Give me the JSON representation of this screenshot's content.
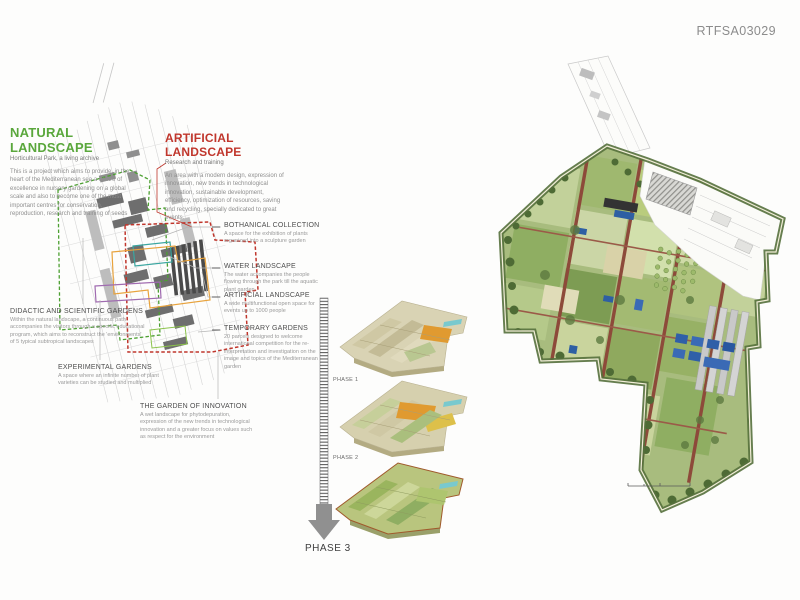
{
  "board": {
    "code": "RTFSA03029"
  },
  "natural_landscape": {
    "title": "NATURAL LANDSCAPE",
    "subtitle": "Horticultural Park, a living archive",
    "body": "This is a project which aims to provide, in the heart of the Mediterranean sea a centre of excellence in nursery gardening on a global scale and also to become one of the most important centres for conservation, reproduction, research and training of seeds"
  },
  "artificial_landscape": {
    "title": "ARTIFICIAL LANDSCAPE",
    "subtitle": "Research and training",
    "body": "An area with a modern design, expression of innovation, new trends in technological innovation, sustainable development, efficiency, optimization of resources, saving and recycling, specially dedicated to great events."
  },
  "callouts_right": [
    {
      "title": "BOTHANICAL COLLECTION",
      "body": "A space for the exhibition of plants organized into a sculpture garden"
    },
    {
      "title": "WATER LANDSCAPE",
      "body": "The water accompanies the people flowing through the park till the aquatic plant garden"
    },
    {
      "title": "ARTIFICIAL LANDSCAPE",
      "body": "A wide multifunctional open space for events up to 1000 people"
    },
    {
      "title": "TEMPORARY GARDENS",
      "body": "20 parcels designed to welcome international competition for the re-interpretation and investigation on the image and topics of the Mediterranean garden"
    }
  ],
  "callouts_left": [
    {
      "title": "DIDACTIC AND SCIENTIFIC GARDENS",
      "body": "Within the natural landscape, a continuous path accompanies the visitors through a specific educational program, which aims to reconstruct the 'environments' of 5 typical subtropical landscapes"
    },
    {
      "title": "EXPERIMENTAL GARDENS",
      "body": "A space where an infinite number of plant varieties can be studied and multiplied"
    },
    {
      "title": "THE GARDEN OF INNOVATION",
      "body": "A wet landscape for phytodepuration, expression of the new trends in technological innovation and a greater focus on values such as respect for the environment"
    }
  ],
  "phases": [
    {
      "label": "PHASE 1"
    },
    {
      "label": "PHASE 2"
    },
    {
      "label": "PHASE 3"
    }
  ],
  "colors": {
    "natural_green": "#5aa73c",
    "artificial_red": "#c0362c",
    "water_teal": "#3aa6a0",
    "temporary_orange": "#e8a33d",
    "didactic_purple": "#a06bb0",
    "path_brown": "#8d4a3a",
    "water_blue": "#2e5fa3"
  }
}
